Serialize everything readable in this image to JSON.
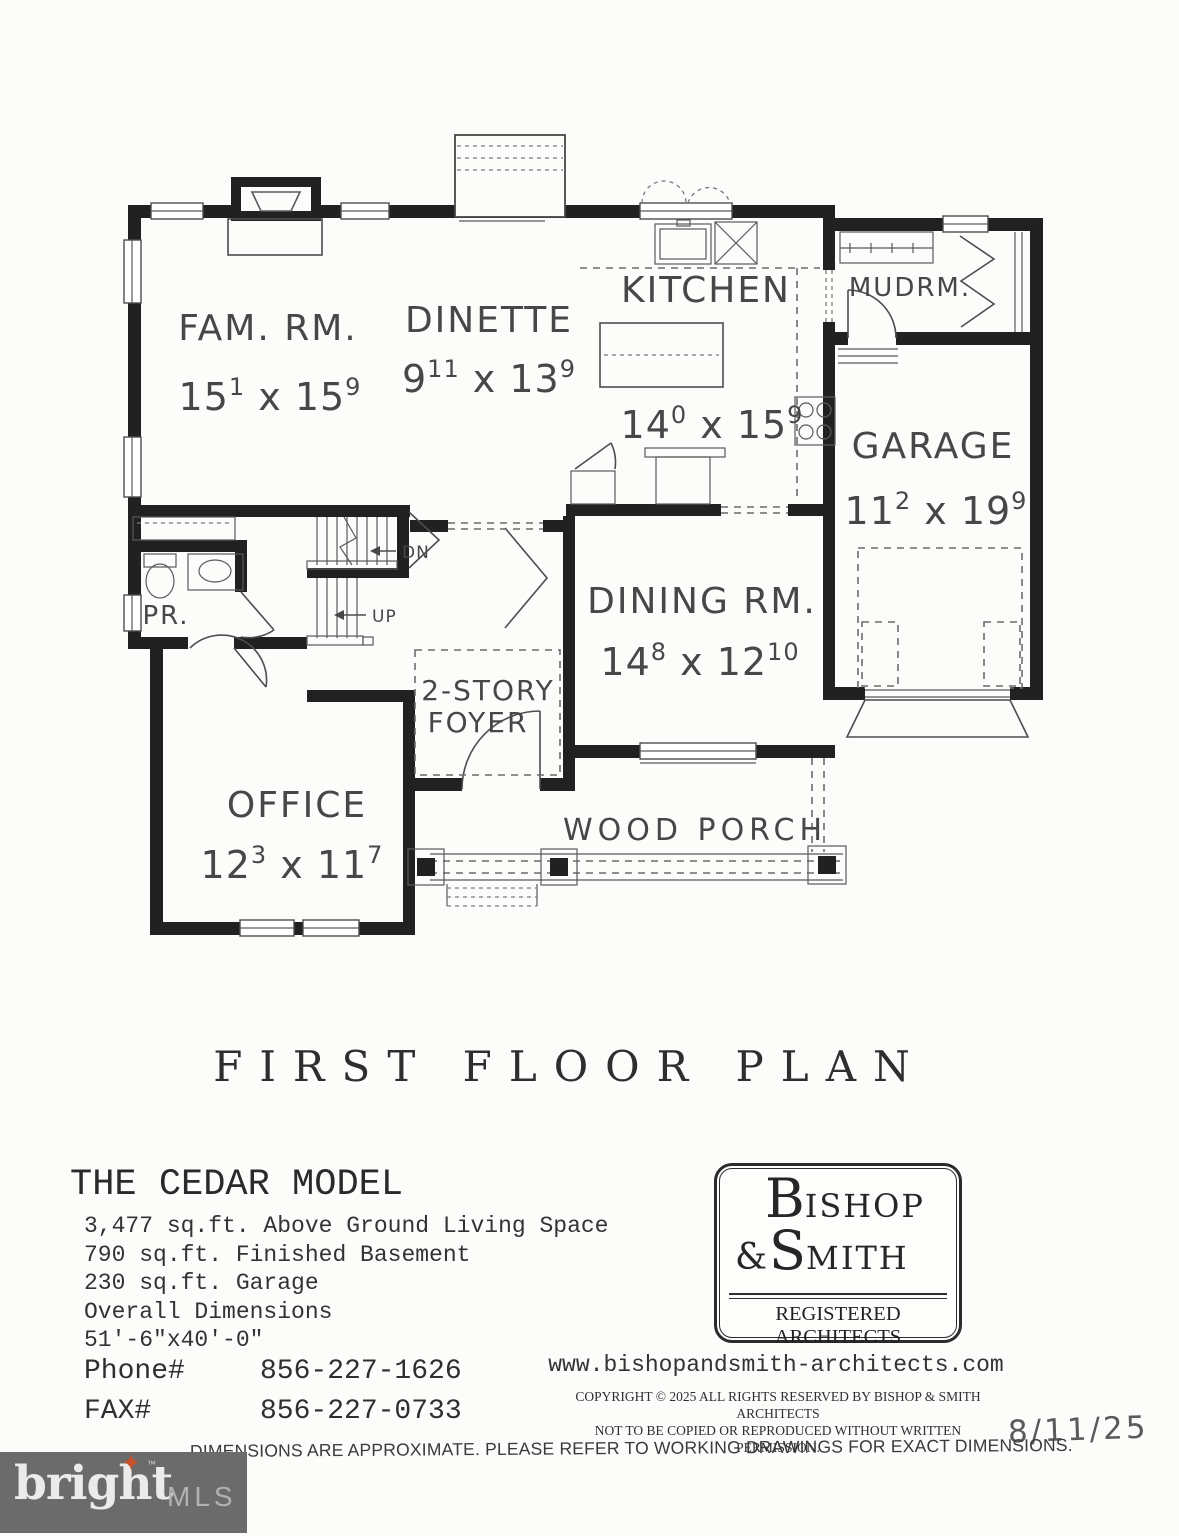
{
  "plan": {
    "title": "FIRST FLOOR PLAN",
    "rooms": {
      "family": {
        "name": "FAM. RM.",
        "d": [
          "15",
          "1",
          " x 15",
          "9"
        ]
      },
      "dinette": {
        "name": "DINETTE",
        "d": [
          "9",
          "11",
          " x 13",
          "9"
        ]
      },
      "kitchen": {
        "name": "KITCHEN",
        "d": [
          "14",
          "0",
          " x 15",
          "9"
        ]
      },
      "mudroom": {
        "name": "MUDRM."
      },
      "garage": {
        "name": "GARAGE",
        "d": [
          "11",
          "2",
          " x 19",
          "9"
        ]
      },
      "dining": {
        "name": "DINING RM.",
        "d": [
          "14",
          "8",
          " x 12",
          "10"
        ]
      },
      "powder": {
        "name": "PR."
      },
      "foyer": {
        "line1": "2-STORY",
        "line2": "FOYER"
      },
      "office": {
        "name": "OFFICE",
        "d": [
          "12",
          "3",
          " x 11",
          "7"
        ]
      },
      "porch": {
        "name": "WOOD PORCH"
      }
    },
    "stairs": {
      "down": "DN",
      "up": "UP"
    }
  },
  "model": {
    "name": "THE CEDAR MODEL",
    "specs": [
      "3,477 sq.ft. Above Ground Living Space",
      "790 sq.ft. Finished Basement",
      "230 sq.ft. Garage",
      "Overall Dimensions",
      "51'-6\"x40'-0\""
    ],
    "phone_label": "Phone#",
    "phone": "856-227-1626",
    "fax_label": "FAX#",
    "fax": "856-227-0733"
  },
  "architect": {
    "name_big1": "B",
    "name_rest1": "ISHOP",
    "amp": "&",
    "name_big2": "S",
    "name_rest2": "MITH",
    "subtitle": "REGISTERED ARCHITECTS",
    "website": "www.bishopandsmith-architects.com",
    "copyright_line1": "COPYRIGHT © 2025 ALL RIGHTS RESERVED BY BISHOP & SMITH ARCHITECTS",
    "copyright_line2": "NOT TO BE COPIED OR REPRODUCED WITHOUT WRITTEN PERMISSION.",
    "date": "8/11/25"
  },
  "disclaimer": "DIMENSIONS ARE APPROXIMATE.  PLEASE REFER TO WORKING DRAWINGS FOR EXACT DIMENSIONS.",
  "watermark": {
    "brand": "bright",
    "tm": "™",
    "suffix": "MLS",
    "star_glyph": "✦",
    "star_color": "#c8502b",
    "bg_color": "#6b6b6b"
  }
}
